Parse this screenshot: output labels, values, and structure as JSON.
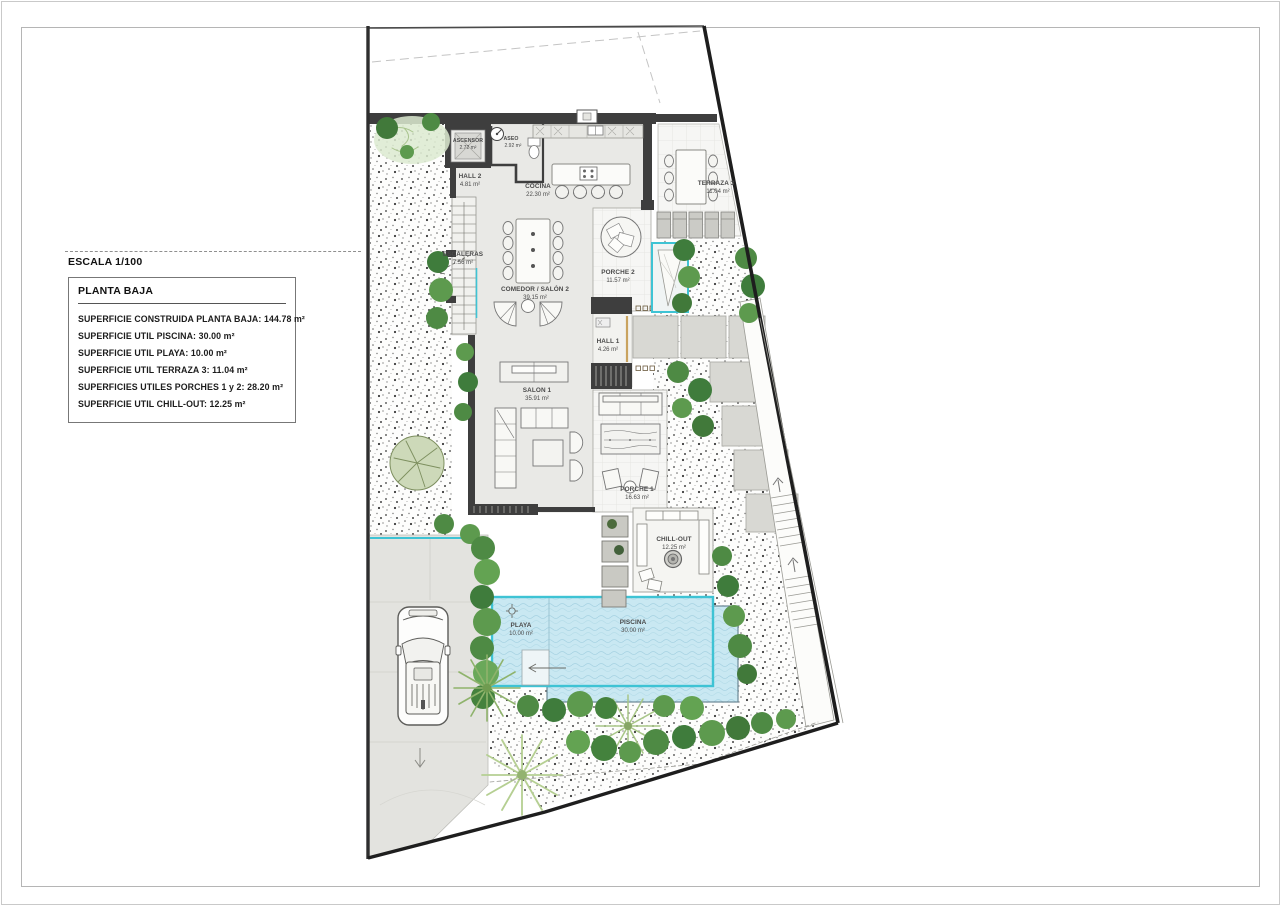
{
  "legend": {
    "scale_label": "ESCALA 1/100",
    "title": "PLANTA BAJA",
    "items": [
      "SUPERFICIE CONSTRUIDA PLANTA BAJA: 144.78 m²",
      "SUPERFICIE UTIL PISCINA: 30.00 m²",
      "SUPERFICIE UTIL PLAYA: 10.00 m²",
      "SUPERFICIE UTIL TERRAZA 3: 11.04 m²",
      "SUPERFICIES UTILES PORCHES 1 y 2: 28.20 m²",
      "SUPERFICIE UTIL CHILL-OUT: 12.25 m²"
    ]
  },
  "rooms": [
    {
      "id": "ascensor",
      "name": "ASCENSOR",
      "area": "2.72 m²"
    },
    {
      "id": "aseo",
      "name": "ASEO",
      "area": "2.92 m²"
    },
    {
      "id": "hall2",
      "name": "HALL 2",
      "area": "4.81 m²"
    },
    {
      "id": "cocina",
      "name": "COCINA",
      "area": "22.30 m²"
    },
    {
      "id": "terraza3",
      "name": "TERRAZA 3",
      "area": "11.04 m²"
    },
    {
      "id": "escaleras",
      "name": "ESCALERAS",
      "area": "7.56 m²"
    },
    {
      "id": "comedor",
      "name": "COMEDOR / SALÓN 2",
      "area": "39.15 m²"
    },
    {
      "id": "porche2",
      "name": "PORCHE 2",
      "area": "11.57 m²"
    },
    {
      "id": "hall1",
      "name": "HALL 1",
      "area": "4.26 m²"
    },
    {
      "id": "salon1",
      "name": "SALON 1",
      "area": "35.91 m²"
    },
    {
      "id": "porche1",
      "name": "PORCHE 1",
      "area": "16.63 m²"
    },
    {
      "id": "chillout",
      "name": "CHILL-OUT",
      "area": "12.25 m²"
    },
    {
      "id": "playa",
      "name": "PLAYA",
      "area": "10.00 m²"
    },
    {
      "id": "piscina",
      "name": "PISCINA",
      "area": "30.00 m²"
    }
  ],
  "colors": {
    "wall": "#3e3e3e",
    "interior_floor": "#e9e9e6",
    "tile_floor": "#f6f6f4",
    "paving_slab": "#d8d8d3",
    "pool_water": "#c9e8f2",
    "pool_border_teal": "#3ec3d4",
    "green_dark": "#3f7c3c",
    "green_mid": "#5d9a4e",
    "green_light": "#8abf6e",
    "driveway": "#e3e3df"
  }
}
